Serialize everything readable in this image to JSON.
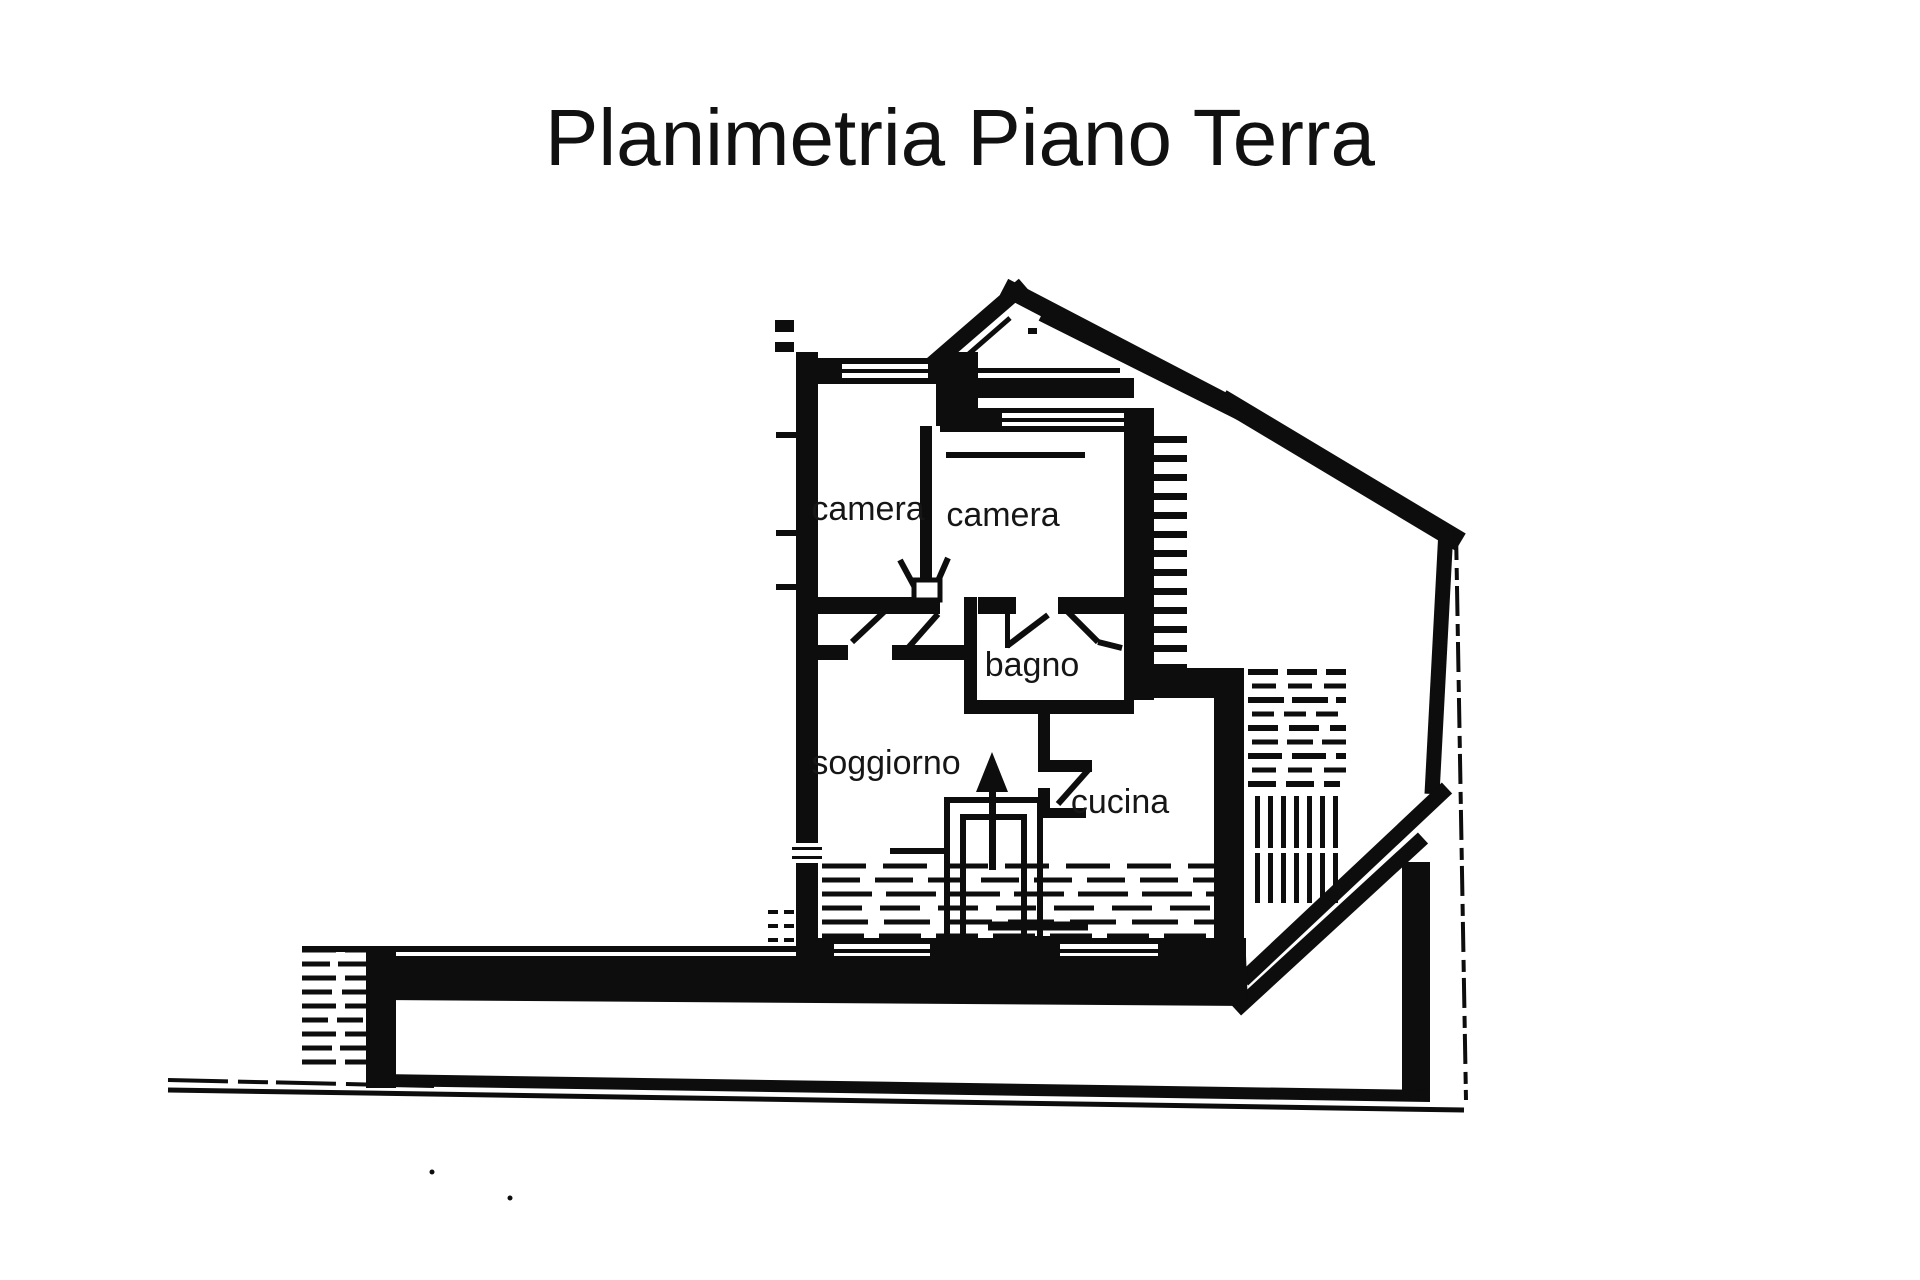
{
  "title": "Planimetria Piano Terra",
  "floor_plan": {
    "rooms": [
      {
        "id": "camera-1",
        "label": "camera"
      },
      {
        "id": "camera-2",
        "label": "camera"
      },
      {
        "id": "bagno",
        "label": "bagno"
      },
      {
        "id": "soggiorno",
        "label": "soggiorno"
      },
      {
        "id": "cucina",
        "label": "cucina"
      }
    ]
  },
  "colors": {
    "ink": "#0d0d0d",
    "paper": "#ffffff"
  }
}
